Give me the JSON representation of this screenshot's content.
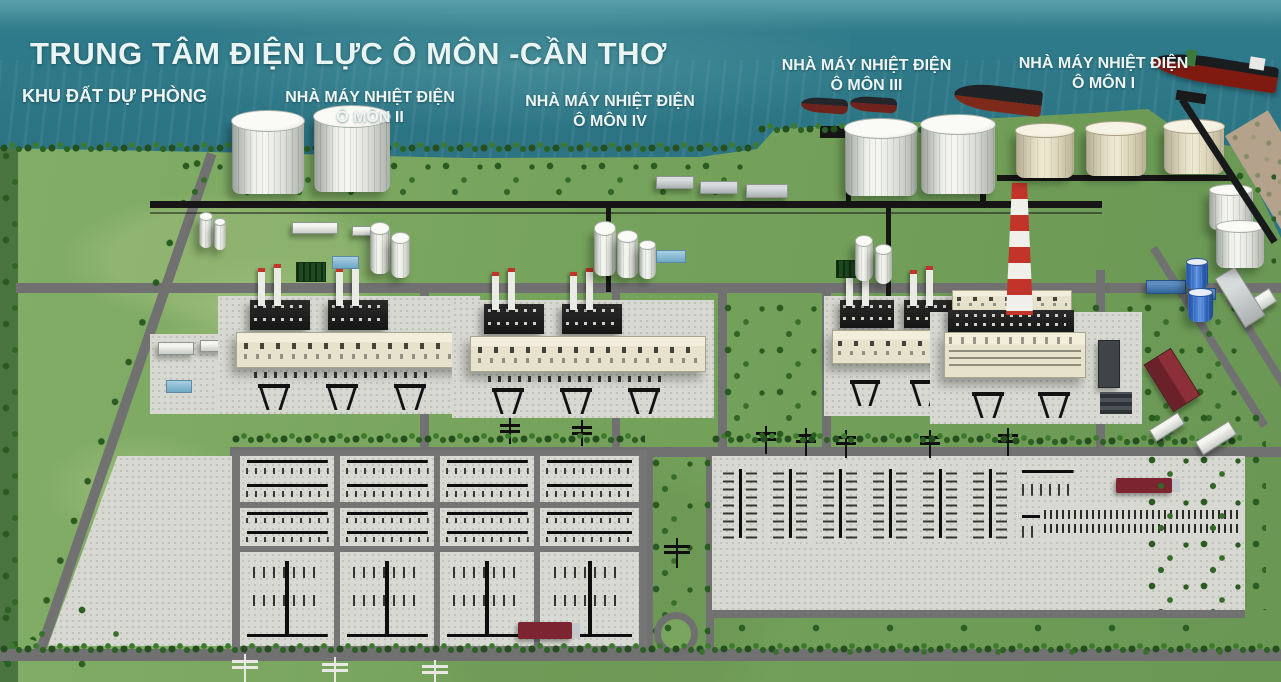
{
  "title": "TRUNG TÂM ĐIỆN LỰC Ô MÔN -CẦN THƠ",
  "areas": {
    "reserve": {
      "label": "KHU ĐẤT DỰ PHÒNG"
    },
    "omon2": {
      "line1": "NHÀ MÁY NHIỆT ĐIỆN",
      "line2": "Ô MÔN II"
    },
    "omon4": {
      "line1": "NHÀ MÁY NHIỆT ĐIỆN",
      "line2": "Ô MÔN IV"
    },
    "omon3": {
      "line1": "NHÀ MÁY NHIỆT ĐIỆN",
      "line2": "Ô MÔN III"
    },
    "omon1": {
      "line1": "NHÀ MÁY NHIỆT ĐIỆN",
      "line2": "Ô MÔN I"
    }
  },
  "scene_objects": [
    "river-water",
    "shoreline-tree-row",
    "cargo-ship",
    "barge",
    "tanker-ship",
    "jetty-pier",
    "lng-storage-tank",
    "fuel-oil-tank",
    "striped-chimney",
    "turbine-hall",
    "hrsg-boiler-block",
    "switchyard-bay",
    "transmission-tower",
    "pipe-rack",
    "service-truck",
    "roundabout",
    "reserve-green-field",
    "sand-shore"
  ],
  "colors": {
    "water": "#2b7282",
    "grass": "#76a35c",
    "concrete": "#d8d8d2",
    "road": "#717171",
    "tree": "#2f6129",
    "chimney_red": "#c23429",
    "tank_white": "#eef0ea",
    "tank_cream": "#e7e1c8",
    "tank_blue": "#2e66c4",
    "ship_hull": "#7e1a10",
    "label_text": "#edf5f3"
  }
}
